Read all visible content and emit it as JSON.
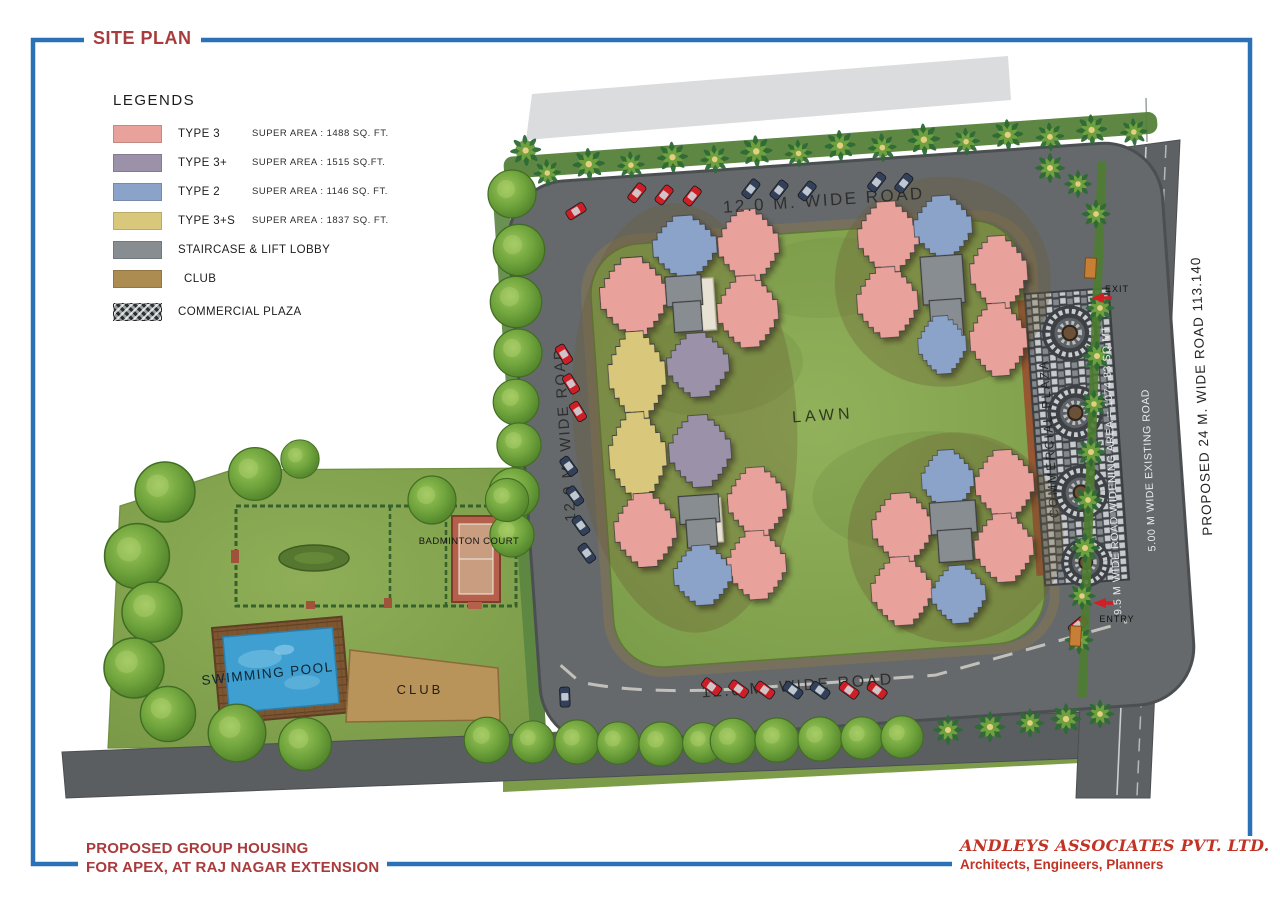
{
  "title": "SITE PLAN",
  "legend": {
    "heading": "LEGENDS",
    "items": [
      {
        "label": "TYPE 3",
        "area": "SUPER AREA  :  1488 SQ. FT.",
        "color": "#e8a19b"
      },
      {
        "label": "TYPE 3+",
        "area": "SUPER AREA  :   1515 SQ.FT.",
        "color": "#9b92aa"
      },
      {
        "label": "TYPE 2",
        "area": "SUPER AREA :  1146 SQ. FT.",
        "color": "#8ba3c9"
      },
      {
        "label": "TYPE 3+S",
        "area": "SUPER AREA  :  1837 SQ. FT.",
        "color": "#d9c87b"
      },
      {
        "label": "STAIRCASE & LIFT LOBBY",
        "area": "",
        "color": "#878d91"
      },
      {
        "label": "CLUB",
        "area": "",
        "color": "#ac8c50"
      },
      {
        "label": "COMMERCIAL PLAZA",
        "area": "",
        "pattern": "mosaic-hatch"
      }
    ]
  },
  "plan": {
    "roads": {
      "top": "12.0 M. WIDE ROAD",
      "left": "12.0 M. WIDE ROAD",
      "bottom": "12.0 M. WIDE ROAD",
      "widening": "9.5 M WIDE ROAD WIDENING AREA = 1074.83 SQ.MT",
      "existing": "5.00 M WIDE EXISTING ROAD",
      "proposed": "PROPOSED 24 M. WIDE ROAD 113.140"
    },
    "labels": {
      "lawn": "LAWN",
      "commercial_plaza": "COMMERCIAL PLAZA",
      "swimming_pool": "SWIMMING POOL",
      "club": "CLUB",
      "badminton_court": "BADMINTON COURT",
      "exit": "EXIT",
      "entry": "ENTRY"
    }
  },
  "footer": {
    "project_line1": "PROPOSED GROUP HOUSING",
    "project_line2": "FOR APEX, AT RAJ NAGAR EXTENSION",
    "firm_name": "ANDLEYS ASSOCIATES PVT. LTD.",
    "firm_tagline": "Architects, Engineers, Planners"
  },
  "colors": {
    "frame_blue": "#2a71b8",
    "title_red": "#a93b3c",
    "firm_red": "#c13325",
    "road_gray": "#66696b",
    "grass_green": "#84a24e",
    "lawn_green": "#87a751",
    "water_blue": "#3f9fd0",
    "type3_pink": "#e8a19b",
    "type3plus_purple": "#9b92aa",
    "type2_blue": "#8ba3c9",
    "type3ps_yellow": "#d9c87b",
    "core_gray": "#878d91",
    "club_brown": "#b8935a",
    "car_red": "#cf1f26",
    "car_navy": "#32405a"
  }
}
